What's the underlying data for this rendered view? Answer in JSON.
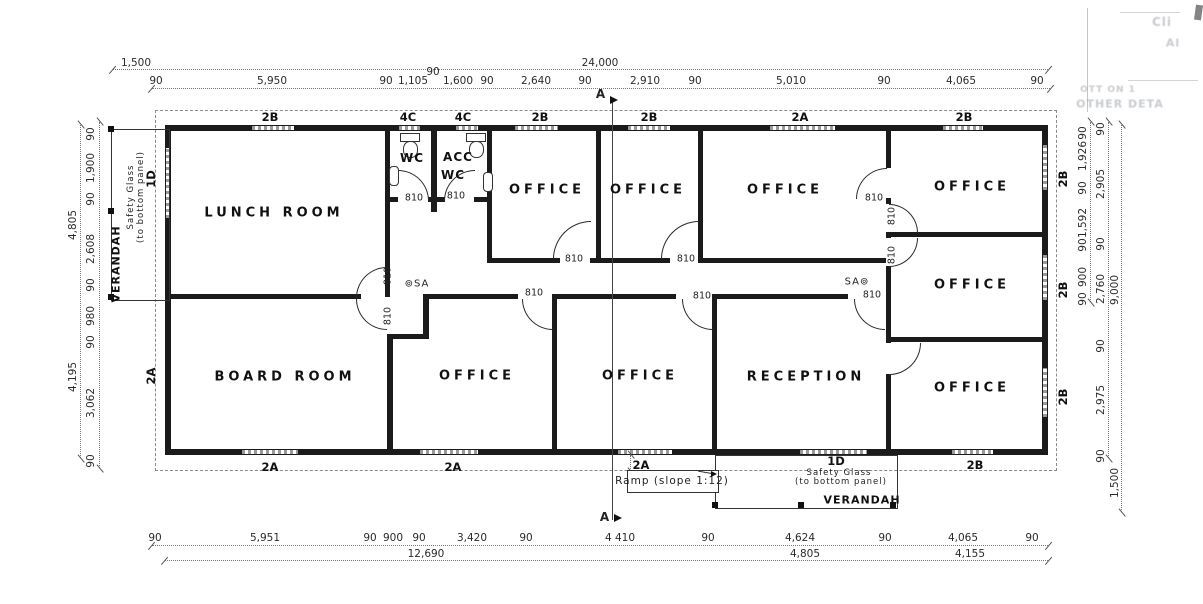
{
  "drawing_type": "floor plan",
  "dims": [
    {
      "t": "1,500",
      "x": 136,
      "y": 63
    },
    {
      "t": "24,000",
      "x": 600,
      "y": 63
    },
    {
      "t": "90",
      "x": 156,
      "y": 81
    },
    {
      "t": "5,950",
      "x": 272,
      "y": 81
    },
    {
      "t": "90",
      "x": 386,
      "y": 81
    },
    {
      "t": "1,105",
      "x": 413,
      "y": 81
    },
    {
      "t": "90",
      "x": 433,
      "y": 72
    },
    {
      "t": "1,600",
      "x": 458,
      "y": 81
    },
    {
      "t": "90",
      "x": 487,
      "y": 81
    },
    {
      "t": "2,640",
      "x": 536,
      "y": 81
    },
    {
      "t": "90",
      "x": 585,
      "y": 81
    },
    {
      "t": "2,910",
      "x": 645,
      "y": 81
    },
    {
      "t": "90",
      "x": 695,
      "y": 81
    },
    {
      "t": "5,010",
      "x": 791,
      "y": 81
    },
    {
      "t": "90",
      "x": 884,
      "y": 81
    },
    {
      "t": "4,065",
      "x": 961,
      "y": 81
    },
    {
      "t": "90",
      "x": 1037,
      "y": 81
    },
    {
      "t": "90",
      "x": 155,
      "y": 538
    },
    {
      "t": "5,951",
      "x": 265,
      "y": 538
    },
    {
      "t": "90",
      "x": 370,
      "y": 538
    },
    {
      "t": "900",
      "x": 393,
      "y": 538
    },
    {
      "t": "90",
      "x": 419,
      "y": 538
    },
    {
      "t": "3,420",
      "x": 472,
      "y": 538
    },
    {
      "t": "90",
      "x": 526,
      "y": 538
    },
    {
      "t": "4 410",
      "x": 620,
      "y": 538
    },
    {
      "t": "90",
      "x": 708,
      "y": 538
    },
    {
      "t": "4,624",
      "x": 800,
      "y": 538
    },
    {
      "t": "90",
      "x": 885,
      "y": 538
    },
    {
      "t": "4,065",
      "x": 963,
      "y": 538
    },
    {
      "t": "90",
      "x": 1032,
      "y": 538
    },
    {
      "t": "12,690",
      "x": 426,
      "y": 554
    },
    {
      "t": "4,805",
      "x": 805,
      "y": 554
    },
    {
      "t": "4,155",
      "x": 970,
      "y": 554
    },
    {
      "t": "90",
      "x": 91,
      "y": 134,
      "r": 1
    },
    {
      "t": "1,900",
      "x": 91,
      "y": 168,
      "r": 1
    },
    {
      "t": "90",
      "x": 91,
      "y": 199,
      "r": 1
    },
    {
      "t": "2,608",
      "x": 91,
      "y": 249,
      "r": 1
    },
    {
      "t": "90",
      "x": 91,
      "y": 285,
      "r": 1
    },
    {
      "t": "980",
      "x": 91,
      "y": 316,
      "r": 1
    },
    {
      "t": "90",
      "x": 91,
      "y": 342,
      "r": 1
    },
    {
      "t": "3,062",
      "x": 91,
      "y": 403,
      "r": 1
    },
    {
      "t": "90",
      "x": 91,
      "y": 461,
      "r": 1
    },
    {
      "t": "4,805",
      "x": 73,
      "y": 225,
      "r": 1
    },
    {
      "t": "4,195",
      "x": 73,
      "y": 377,
      "r": 1
    },
    {
      "t": "90",
      "x": 1083,
      "y": 133,
      "r": 1
    },
    {
      "t": "1,926",
      "x": 1083,
      "y": 156,
      "r": 1
    },
    {
      "t": "90",
      "x": 1083,
      "y": 188,
      "r": 1
    },
    {
      "t": "1,592",
      "x": 1083,
      "y": 223,
      "r": 1
    },
    {
      "t": "90",
      "x": 1083,
      "y": 245,
      "r": 1
    },
    {
      "t": "900",
      "x": 1083,
      "y": 277,
      "r": 1
    },
    {
      "t": "90",
      "x": 1083,
      "y": 299,
      "r": 1
    },
    {
      "t": "90",
      "x": 1101,
      "y": 129,
      "r": 1
    },
    {
      "t": "2,905",
      "x": 1101,
      "y": 184,
      "r": 1
    },
    {
      "t": "90",
      "x": 1101,
      "y": 244,
      "r": 1
    },
    {
      "t": "2,760",
      "x": 1101,
      "y": 289,
      "r": 1
    },
    {
      "t": "90",
      "x": 1101,
      "y": 346,
      "r": 1
    },
    {
      "t": "2,975",
      "x": 1101,
      "y": 400,
      "r": 1
    },
    {
      "t": "90",
      "x": 1101,
      "y": 456,
      "r": 1
    },
    {
      "t": "9,000",
      "x": 1115,
      "y": 290,
      "r": 1
    },
    {
      "t": "1,500",
      "x": 1115,
      "y": 483,
      "r": 1
    }
  ],
  "wall_labels": [
    {
      "t": "2B",
      "x": 270,
      "y": 117
    },
    {
      "t": "4C",
      "x": 408,
      "y": 117
    },
    {
      "t": "4C",
      "x": 463,
      "y": 117
    },
    {
      "t": "2B",
      "x": 540,
      "y": 117
    },
    {
      "t": "2B",
      "x": 649,
      "y": 117
    },
    {
      "t": "2A",
      "x": 800,
      "y": 117
    },
    {
      "t": "2B",
      "x": 964,
      "y": 117
    },
    {
      "t": "2A",
      "x": 270,
      "y": 467
    },
    {
      "t": "2A",
      "x": 453,
      "y": 467
    },
    {
      "t": "2A",
      "x": 641,
      "y": 465
    },
    {
      "t": "1D",
      "x": 836,
      "y": 461
    },
    {
      "t": "2B",
      "x": 975,
      "y": 465
    },
    {
      "t": "1D",
      "x": 151,
      "y": 179,
      "r": 1
    },
    {
      "t": "2A",
      "x": 151,
      "y": 376,
      "r": 1
    },
    {
      "t": "2B",
      "x": 1063,
      "y": 179,
      "r": 1
    },
    {
      "t": "2B",
      "x": 1063,
      "y": 290,
      "r": 1
    },
    {
      "t": "2B",
      "x": 1063,
      "y": 397,
      "r": 1
    }
  ],
  "door_labels": [
    {
      "t": "810",
      "x": 414,
      "y": 198
    },
    {
      "t": "810",
      "x": 456,
      "y": 196
    },
    {
      "t": "810",
      "x": 574,
      "y": 259
    },
    {
      "t": "810",
      "x": 686,
      "y": 259
    },
    {
      "t": "810",
      "x": 874,
      "y": 198
    },
    {
      "t": "810",
      "x": 534,
      "y": 293
    },
    {
      "t": "810",
      "x": 702,
      "y": 296
    },
    {
      "t": "810",
      "x": 872,
      "y": 295
    },
    {
      "t": "810",
      "x": 388,
      "y": 276,
      "r": 1
    },
    {
      "t": "810",
      "x": 388,
      "y": 316,
      "r": 1
    },
    {
      "t": "810",
      "x": 892,
      "y": 216,
      "r": 1
    },
    {
      "t": "810",
      "x": 892,
      "y": 255,
      "r": 1
    }
  ],
  "rooms": [
    {
      "t": "LUNCH ROOM",
      "x": 274,
      "y": 213
    },
    {
      "t": "BOARD ROOM",
      "x": 285,
      "y": 377
    },
    {
      "t": "WC",
      "x": 412,
      "y": 158,
      "fs": 12
    },
    {
      "t": "ACC",
      "x": 458,
      "y": 157,
      "fs": 12
    },
    {
      "t": "WC",
      "x": 453,
      "y": 175,
      "fs": 12
    },
    {
      "t": "OFFICE",
      "x": 547,
      "y": 190
    },
    {
      "t": "OFFICE",
      "x": 648,
      "y": 190
    },
    {
      "t": "OFFICE",
      "x": 785,
      "y": 190
    },
    {
      "t": "OFFICE",
      "x": 972,
      "y": 187
    },
    {
      "t": "OFFICE",
      "x": 972,
      "y": 285
    },
    {
      "t": "OFFICE",
      "x": 972,
      "y": 388
    },
    {
      "t": "OFFICE",
      "x": 477,
      "y": 376
    },
    {
      "t": "OFFICE",
      "x": 640,
      "y": 376
    },
    {
      "t": "RECEPTION",
      "x": 806,
      "y": 377
    },
    {
      "t": "VERANDAH",
      "x": 116,
      "y": 264,
      "fs": 11,
      "r": 1
    },
    {
      "t": "VERANDAH",
      "x": 862,
      "y": 500,
      "fs": 11
    }
  ],
  "annotations": [
    {
      "t": "Safety Glass",
      "x": 131,
      "y": 197,
      "fs": 8.5,
      "r": 1
    },
    {
      "t": "(to bottom panel)",
      "x": 141,
      "y": 197,
      "fs": 8.5,
      "r": 1
    },
    {
      "t": "Safety Glass",
      "x": 839,
      "y": 473,
      "fs": 8.5
    },
    {
      "t": "(to bottom panel)",
      "x": 841,
      "y": 482,
      "fs": 8.5
    },
    {
      "t": "Ramp (slope 1:12)",
      "x": 672,
      "y": 481,
      "fs": 10.5
    },
    {
      "t": "⊚SA",
      "x": 417,
      "y": 284,
      "fs": 10
    },
    {
      "t": "SA⊚",
      "x": 857,
      "y": 282,
      "fs": 10
    },
    {
      "t": "A",
      "x": 601,
      "y": 94,
      "fs": 12,
      "b": 1
    },
    {
      "t": "A",
      "x": 605,
      "y": 517,
      "fs": 12,
      "b": 1
    }
  ],
  "artifacts": [
    {
      "t": "Cli",
      "x": 1162,
      "y": 22,
      "fs": 12
    },
    {
      "t": "Al",
      "x": 1173,
      "y": 43,
      "fs": 11
    },
    {
      "t": "OTT ON 1",
      "x": 1108,
      "y": 90,
      "fs": 9
    },
    {
      "t": "OTHER DETA",
      "x": 1120,
      "y": 104,
      "fs": 11
    }
  ]
}
